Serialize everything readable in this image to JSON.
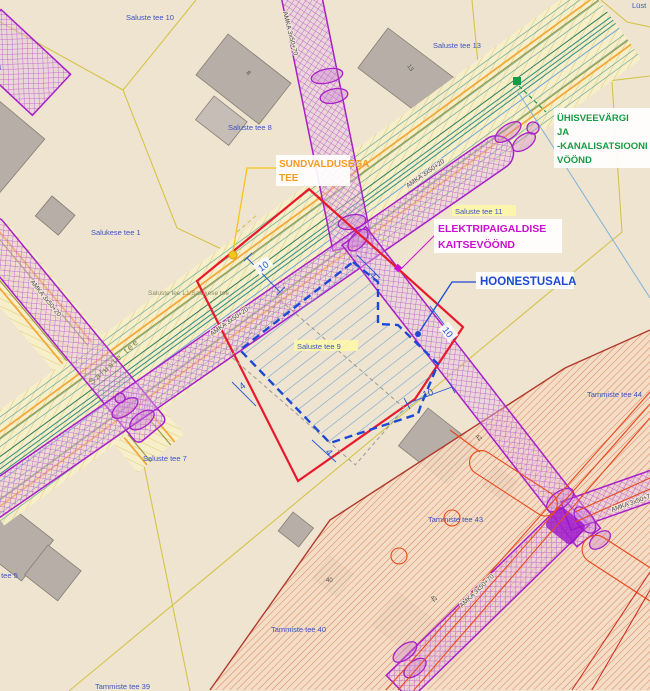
{
  "map": {
    "zone_labels": {
      "sundvaldus_1": "SUNDVALDUSEGA",
      "sundvaldus_2": "TEE",
      "uvk_1": "ÜHISVEEVÄRGI",
      "uvk_2": "JA",
      "uvk_3": "-KANALISATSIOONI",
      "uvk_4": "VÖÖND",
      "elektri_1": "ELEKTRIPAIGALDISE",
      "elektri_2": "KAITSEVÖÖND",
      "hoonestusala": "HOONESTUSALA"
    },
    "parcels": {
      "p10": "Saluste tee 10",
      "p8": "Saluste tee 8",
      "p13": "Saluste tee 13",
      "p1": "Salukese tee 1",
      "p9": "Saluste tee 9",
      "p11": "Saluste tee 11",
      "p7": "Saluste tee 7",
      "p5": "Saluste tee 5",
      "p44": "Tammiste tee 44",
      "p43": "Tammiste tee 43",
      "p40": "Tammiste tee 40",
      "p39": "Tammiste tee 39",
      "corner_partial": "Lüst"
    },
    "roads": {
      "saluste_tee": "Saluste tee",
      "saluste_salukese": "Saluste tee L1/Salukese tee"
    },
    "cables": {
      "amka20": "AMKA 3x50+20",
      "amka70": "AMKA 3x50+70"
    },
    "dimensions": {
      "ten": "10",
      "four": "4"
    },
    "house_numbers": {
      "n13": "13",
      "n42": "42",
      "n40": "40",
      "n8": "8",
      "n3": "3"
    },
    "colors": {
      "zone_electric": "#cb0fd1",
      "zone_water": "#169c46",
      "zone_road_label": "#f59b1e",
      "building_area_blue": "#1b49d6",
      "plot_boundary_red": "#e8192c",
      "parcel_line_yellow": "#d3c44b",
      "corridor_purple": "#a820c8",
      "red_hatch": "#d85a3a"
    }
  }
}
